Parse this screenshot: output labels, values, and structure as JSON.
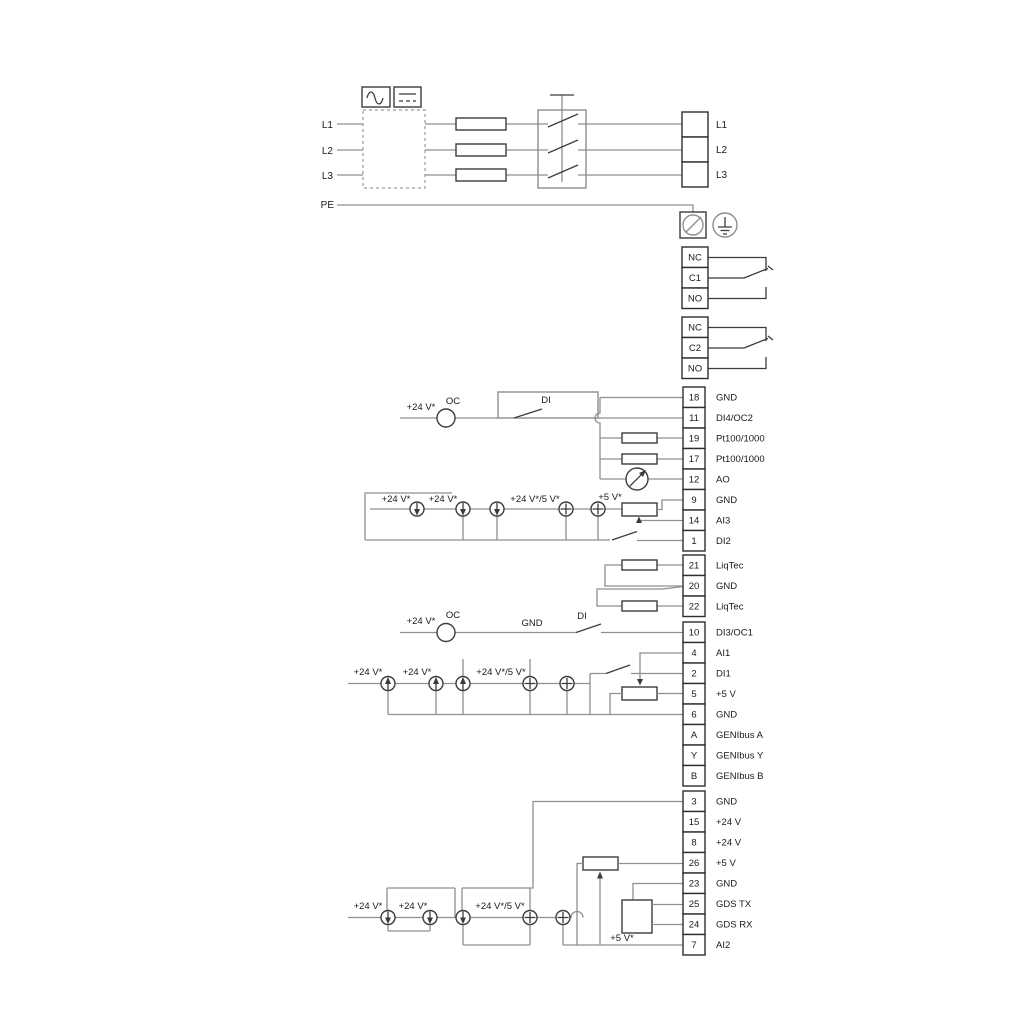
{
  "diagram": {
    "colors": {
      "wire": "#8f8f8f",
      "component": "#3c3c3c",
      "text": "#1a1a1a"
    },
    "power_inputs": [
      {
        "t": "L1",
        "x": 333,
        "y": 128
      },
      {
        "t": "L2",
        "x": 333,
        "y": 154
      },
      {
        "t": "L3",
        "x": 333,
        "y": 179
      },
      {
        "t": "PE",
        "x": 334,
        "y": 208
      }
    ],
    "power_terminals": [
      "L1",
      "L2",
      "L3"
    ],
    "relay1": [
      "NC",
      "C1",
      "NO"
    ],
    "relay2": [
      "NC",
      "C2",
      "NO"
    ],
    "io_top": [
      {
        "n": "18",
        "label": "GND"
      },
      {
        "n": "11",
        "label": "DI4/OC2"
      },
      {
        "n": "19",
        "label": "Pt100/1000"
      },
      {
        "n": "17",
        "label": "Pt100/1000"
      },
      {
        "n": "12",
        "label": "AO"
      },
      {
        "n": "9",
        "label": "GND"
      },
      {
        "n": "14",
        "label": "AI3"
      },
      {
        "n": "1",
        "label": "DI2"
      }
    ],
    "liqtec": [
      {
        "n": "21",
        "label": "LiqTec"
      },
      {
        "n": "20",
        "label": "GND"
      },
      {
        "n": "22",
        "label": "LiqTec"
      }
    ],
    "io_mid": [
      {
        "n": "10",
        "label": "DI3/OC1"
      },
      {
        "n": "4",
        "label": "AI1"
      },
      {
        "n": "2",
        "label": "DI1"
      },
      {
        "n": "5",
        "label": "+5 V"
      },
      {
        "n": "6",
        "label": "GND"
      },
      {
        "n": "A",
        "label": "GENIbus A"
      },
      {
        "n": "Y",
        "label": "GENIbus Y"
      },
      {
        "n": "B",
        "label": "GENIbus B"
      }
    ],
    "io_bottom": [
      {
        "n": "3",
        "label": "GND"
      },
      {
        "n": "15",
        "label": "+24 V"
      },
      {
        "n": "8",
        "label": "+24 V"
      },
      {
        "n": "26",
        "label": "+5 V"
      },
      {
        "n": "23",
        "label": "GND"
      },
      {
        "n": "25",
        "label": "GDS TX"
      },
      {
        "n": "24",
        "label": "GDS RX"
      },
      {
        "n": "7",
        "label": "AI2"
      }
    ],
    "annotations": [
      {
        "t": "+24 V*",
        "x": 421,
        "y": 410
      },
      {
        "t": "OC",
        "x": 453,
        "y": 404
      },
      {
        "t": "DI",
        "x": 546,
        "y": 403
      },
      {
        "t": "+24 V*",
        "x": 396,
        "y": 502
      },
      {
        "t": "+24 V*",
        "x": 443,
        "y": 502
      },
      {
        "t": "+24 V*/5 V*",
        "x": 535,
        "y": 502
      },
      {
        "t": "+5 V*",
        "x": 610,
        "y": 500
      },
      {
        "t": "+24 V*",
        "x": 421,
        "y": 624
      },
      {
        "t": "OC",
        "x": 453,
        "y": 618
      },
      {
        "t": "GND",
        "x": 532,
        "y": 626
      },
      {
        "t": "DI",
        "x": 582,
        "y": 619
      },
      {
        "t": "+24 V*",
        "x": 368,
        "y": 675
      },
      {
        "t": "+24 V*",
        "x": 417,
        "y": 675
      },
      {
        "t": "+24 V*/5 V*",
        "x": 501,
        "y": 675
      },
      {
        "t": "+24 V*",
        "x": 368,
        "y": 909
      },
      {
        "t": "+24 V*",
        "x": 413,
        "y": 909
      },
      {
        "t": "+24 V*/5 V*",
        "x": 500,
        "y": 909
      },
      {
        "t": "+5 V*",
        "x": 622,
        "y": 941
      }
    ]
  }
}
